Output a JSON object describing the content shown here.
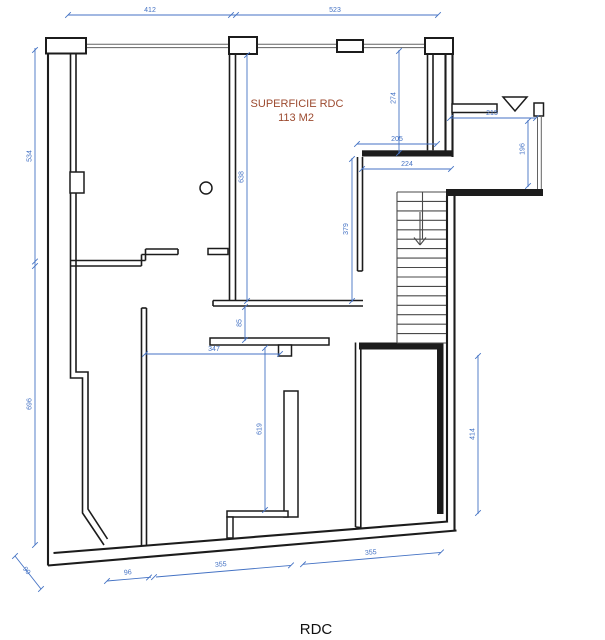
{
  "drawing": {
    "title": "RDC",
    "area_label": {
      "line1": "SUPERFICIE RDC",
      "line2": "113 M2"
    }
  },
  "colors": {
    "wall": "#1c1c1c",
    "dim": "#4472c4",
    "area": "#9c4a2f",
    "window": "#636363",
    "stair": "#4a4a4a"
  },
  "dims": {
    "d412": "412",
    "d523": "523",
    "d534": "534",
    "d696": "696",
    "d638": "638",
    "d274": "274",
    "d205": "205",
    "d224": "224",
    "d215": "215",
    "d196": "196",
    "d379": "379",
    "d85": "85",
    "d347": "347",
    "d619": "619",
    "d414": "414",
    "d96": "96",
    "d355a": "355",
    "d355b": "355",
    "d90": "90"
  }
}
